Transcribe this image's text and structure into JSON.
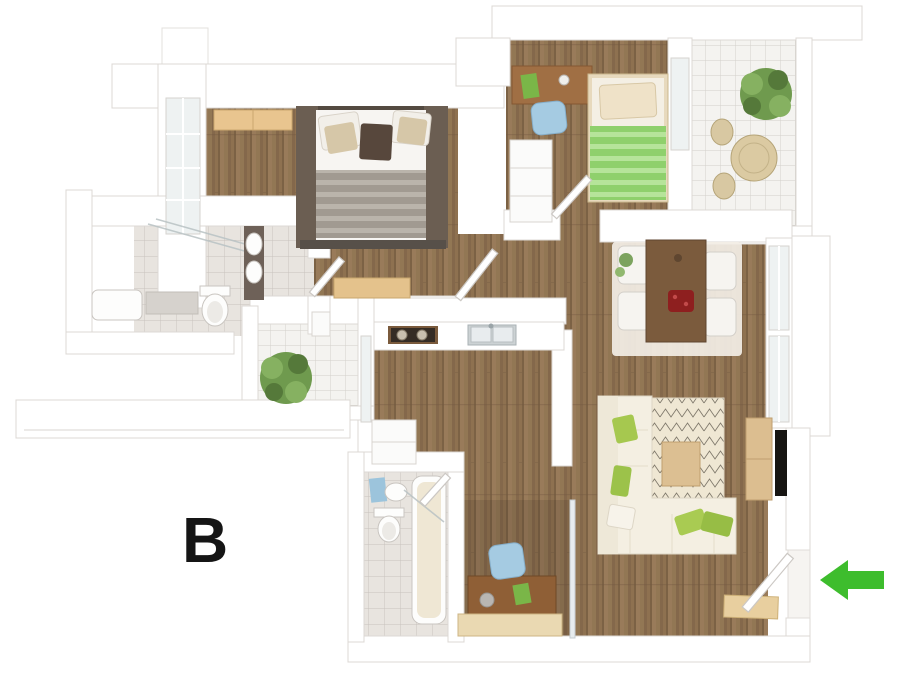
{
  "plan": {
    "unit_label": "B",
    "entrance_arrow": {
      "direction": "left",
      "color": "#3ebd2d"
    },
    "palette": {
      "wall": "#ffffff",
      "wall_line": "#dcd8d4",
      "wood": "#8e7150",
      "wood_dark": "#7c6245",
      "tile": "#e8e4df",
      "tile_line": "#c7c2bc",
      "balcony_tile": "#f4f3f0",
      "balcony_line": "#d2cfca",
      "bed_frame": "#5e5248",
      "blanket_grey": "#a19a91",
      "kids_green": "#8fd06c",
      "desk_wood": "#a06f44",
      "chair_blue": "#a5cbe2",
      "dining_wood": "#7b5b3d",
      "sofa_cream": "#f4efe2",
      "pillow_green": "#a6c84f",
      "rug_cream": "#efe7d3",
      "light_wood": "#dcbf92",
      "tv_black": "#171512",
      "plant_green": "#6f9a4e",
      "rattan": "#dbcaa2",
      "accent_red": "#8e1f1f",
      "towel_blue": "#9cc4dc",
      "bench_wood": "#ead9b2",
      "fixture_white": "#fdfdfc",
      "fixture_line": "#c9c5c0"
    }
  }
}
